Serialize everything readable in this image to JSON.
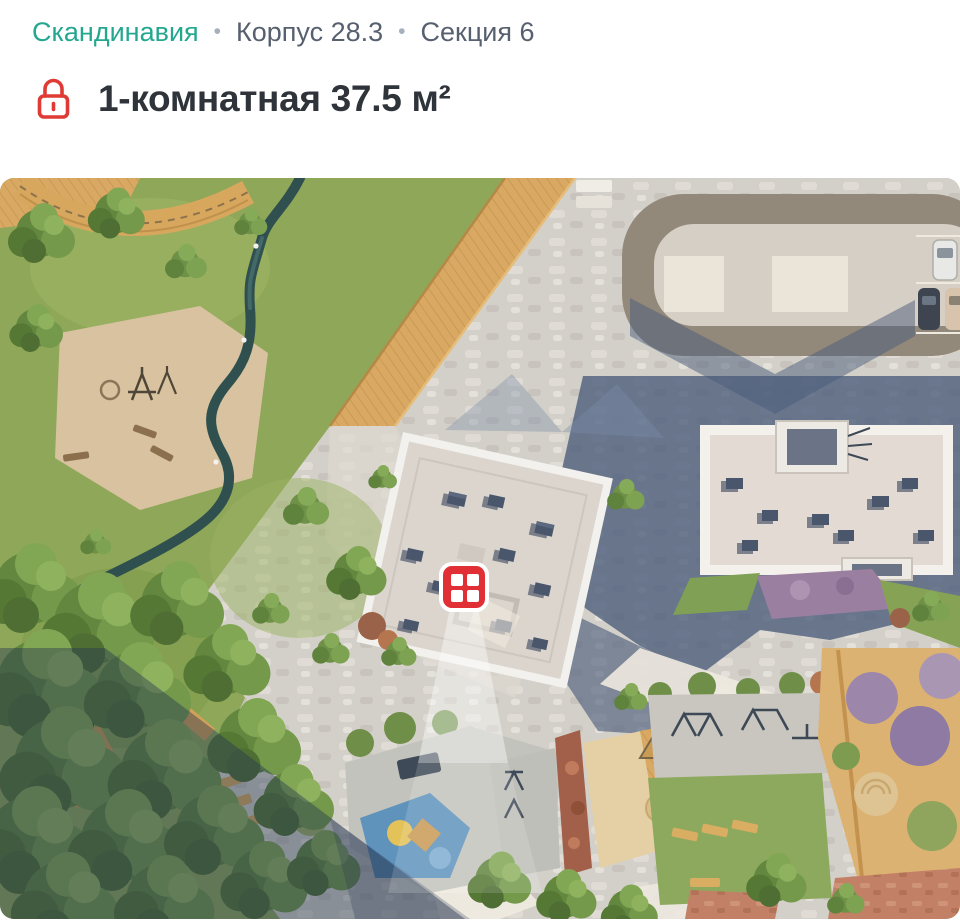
{
  "breadcrumb": {
    "project": "Скандинавия",
    "separator": "•",
    "building": "Корпус 28.3",
    "section": "Секция 6"
  },
  "listing": {
    "title": "1-комнатная 37.5 м²"
  },
  "icons": {
    "lock": "lock-icon",
    "marker": "apartment-location-marker-window-grid"
  },
  "colors": {
    "accent_teal": "#23A78F",
    "breadcrumb_text": "#57606F",
    "title_text": "#2F333A",
    "lock_red": "#DF3A33",
    "marker_red": "#E12F36",
    "marker_border": "#FFFFFF"
  },
  "map": {
    "aria_label": "Генплан двора: парк с ручьём, корпуса, парковка, детские площадки; красный маркер на корпусе 28.3"
  }
}
